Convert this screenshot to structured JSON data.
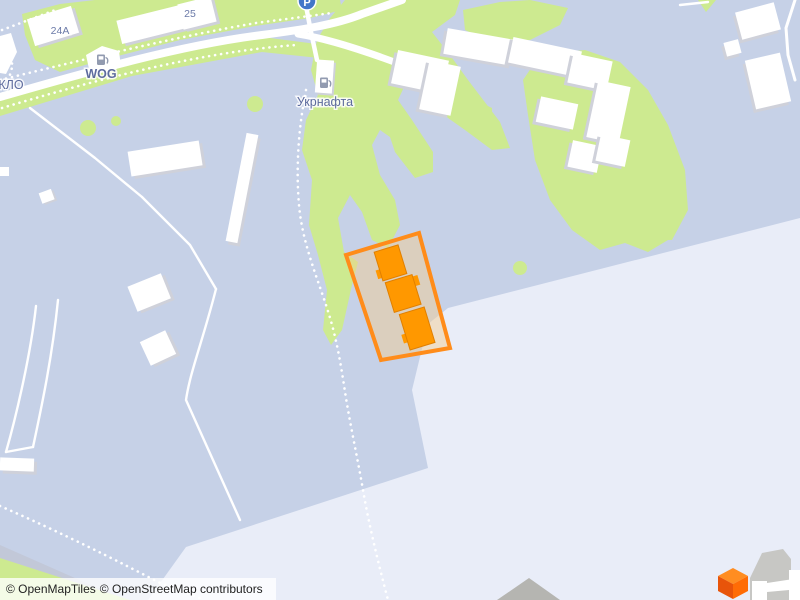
{
  "map": {
    "labels": {
      "house_24a": "24A",
      "house_25": "25",
      "wog": "WOG",
      "klo": "КЛО",
      "ukrnafta": "Укрнафта",
      "parking": "P"
    },
    "attribution": {
      "openmaptiles": "© OpenMapTiles",
      "osm": "© OpenStreetMap contributors"
    },
    "icons": {
      "fuel_wog": "fuel-pump-icon",
      "fuel_ukrnafta": "fuel-pump-icon",
      "parking": "parking-icon",
      "logo_cube": "orange-cube-logo"
    },
    "colors": {
      "base": "#c6d1e7",
      "light_zone": "#e9edf8",
      "green": "#cdea90",
      "road": "#ffffff",
      "building": "#ffffff",
      "building_shadow": "#cfd1da",
      "gray_building": "#b5b5b1",
      "label_blue": "#6b7aa8",
      "parking_blue": "#4276c9",
      "highlight_stroke": "#ff8c1a",
      "highlight_fill": "rgba(244,203,140,0.45)",
      "highlight_building": "#ff9800",
      "cube_top": "#ff8d21",
      "cube_left": "#e8540a",
      "cube_right": "#ff6c06"
    }
  }
}
